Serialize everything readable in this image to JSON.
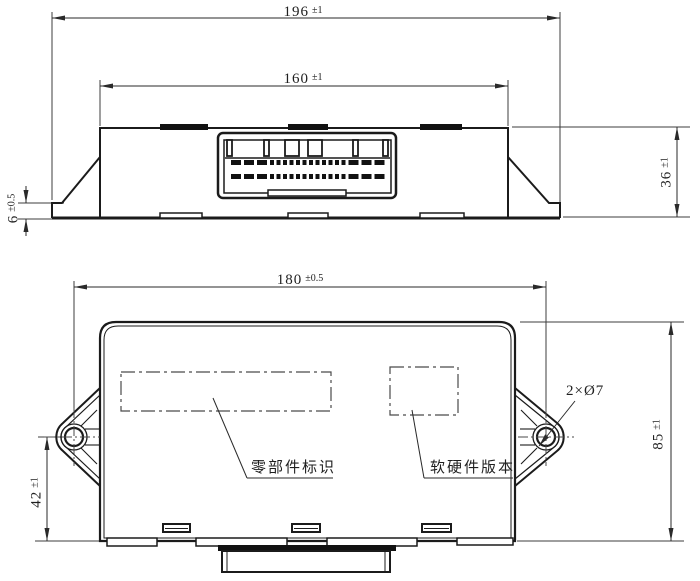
{
  "drawing": {
    "top_view": {
      "overall_width": {
        "value": "196",
        "tolerance": "±1"
      },
      "body_width": {
        "value": "160",
        "tolerance": "±1"
      },
      "body_height": {
        "value": "36",
        "tolerance": "±1"
      },
      "bracket_thickness": {
        "value": "6",
        "tolerance": "±0.5"
      }
    },
    "bottom_view": {
      "mounting_hole_spacing": {
        "value": "180",
        "tolerance": "±0.5"
      },
      "hole_center_to_edge": {
        "value": "42",
        "tolerance": "±1"
      },
      "body_height": {
        "value": "85",
        "tolerance": "±1"
      },
      "mounting_hole_callout": "2×Ø7",
      "part_id_label": "零部件标识",
      "version_label": "软硬件版本"
    }
  }
}
